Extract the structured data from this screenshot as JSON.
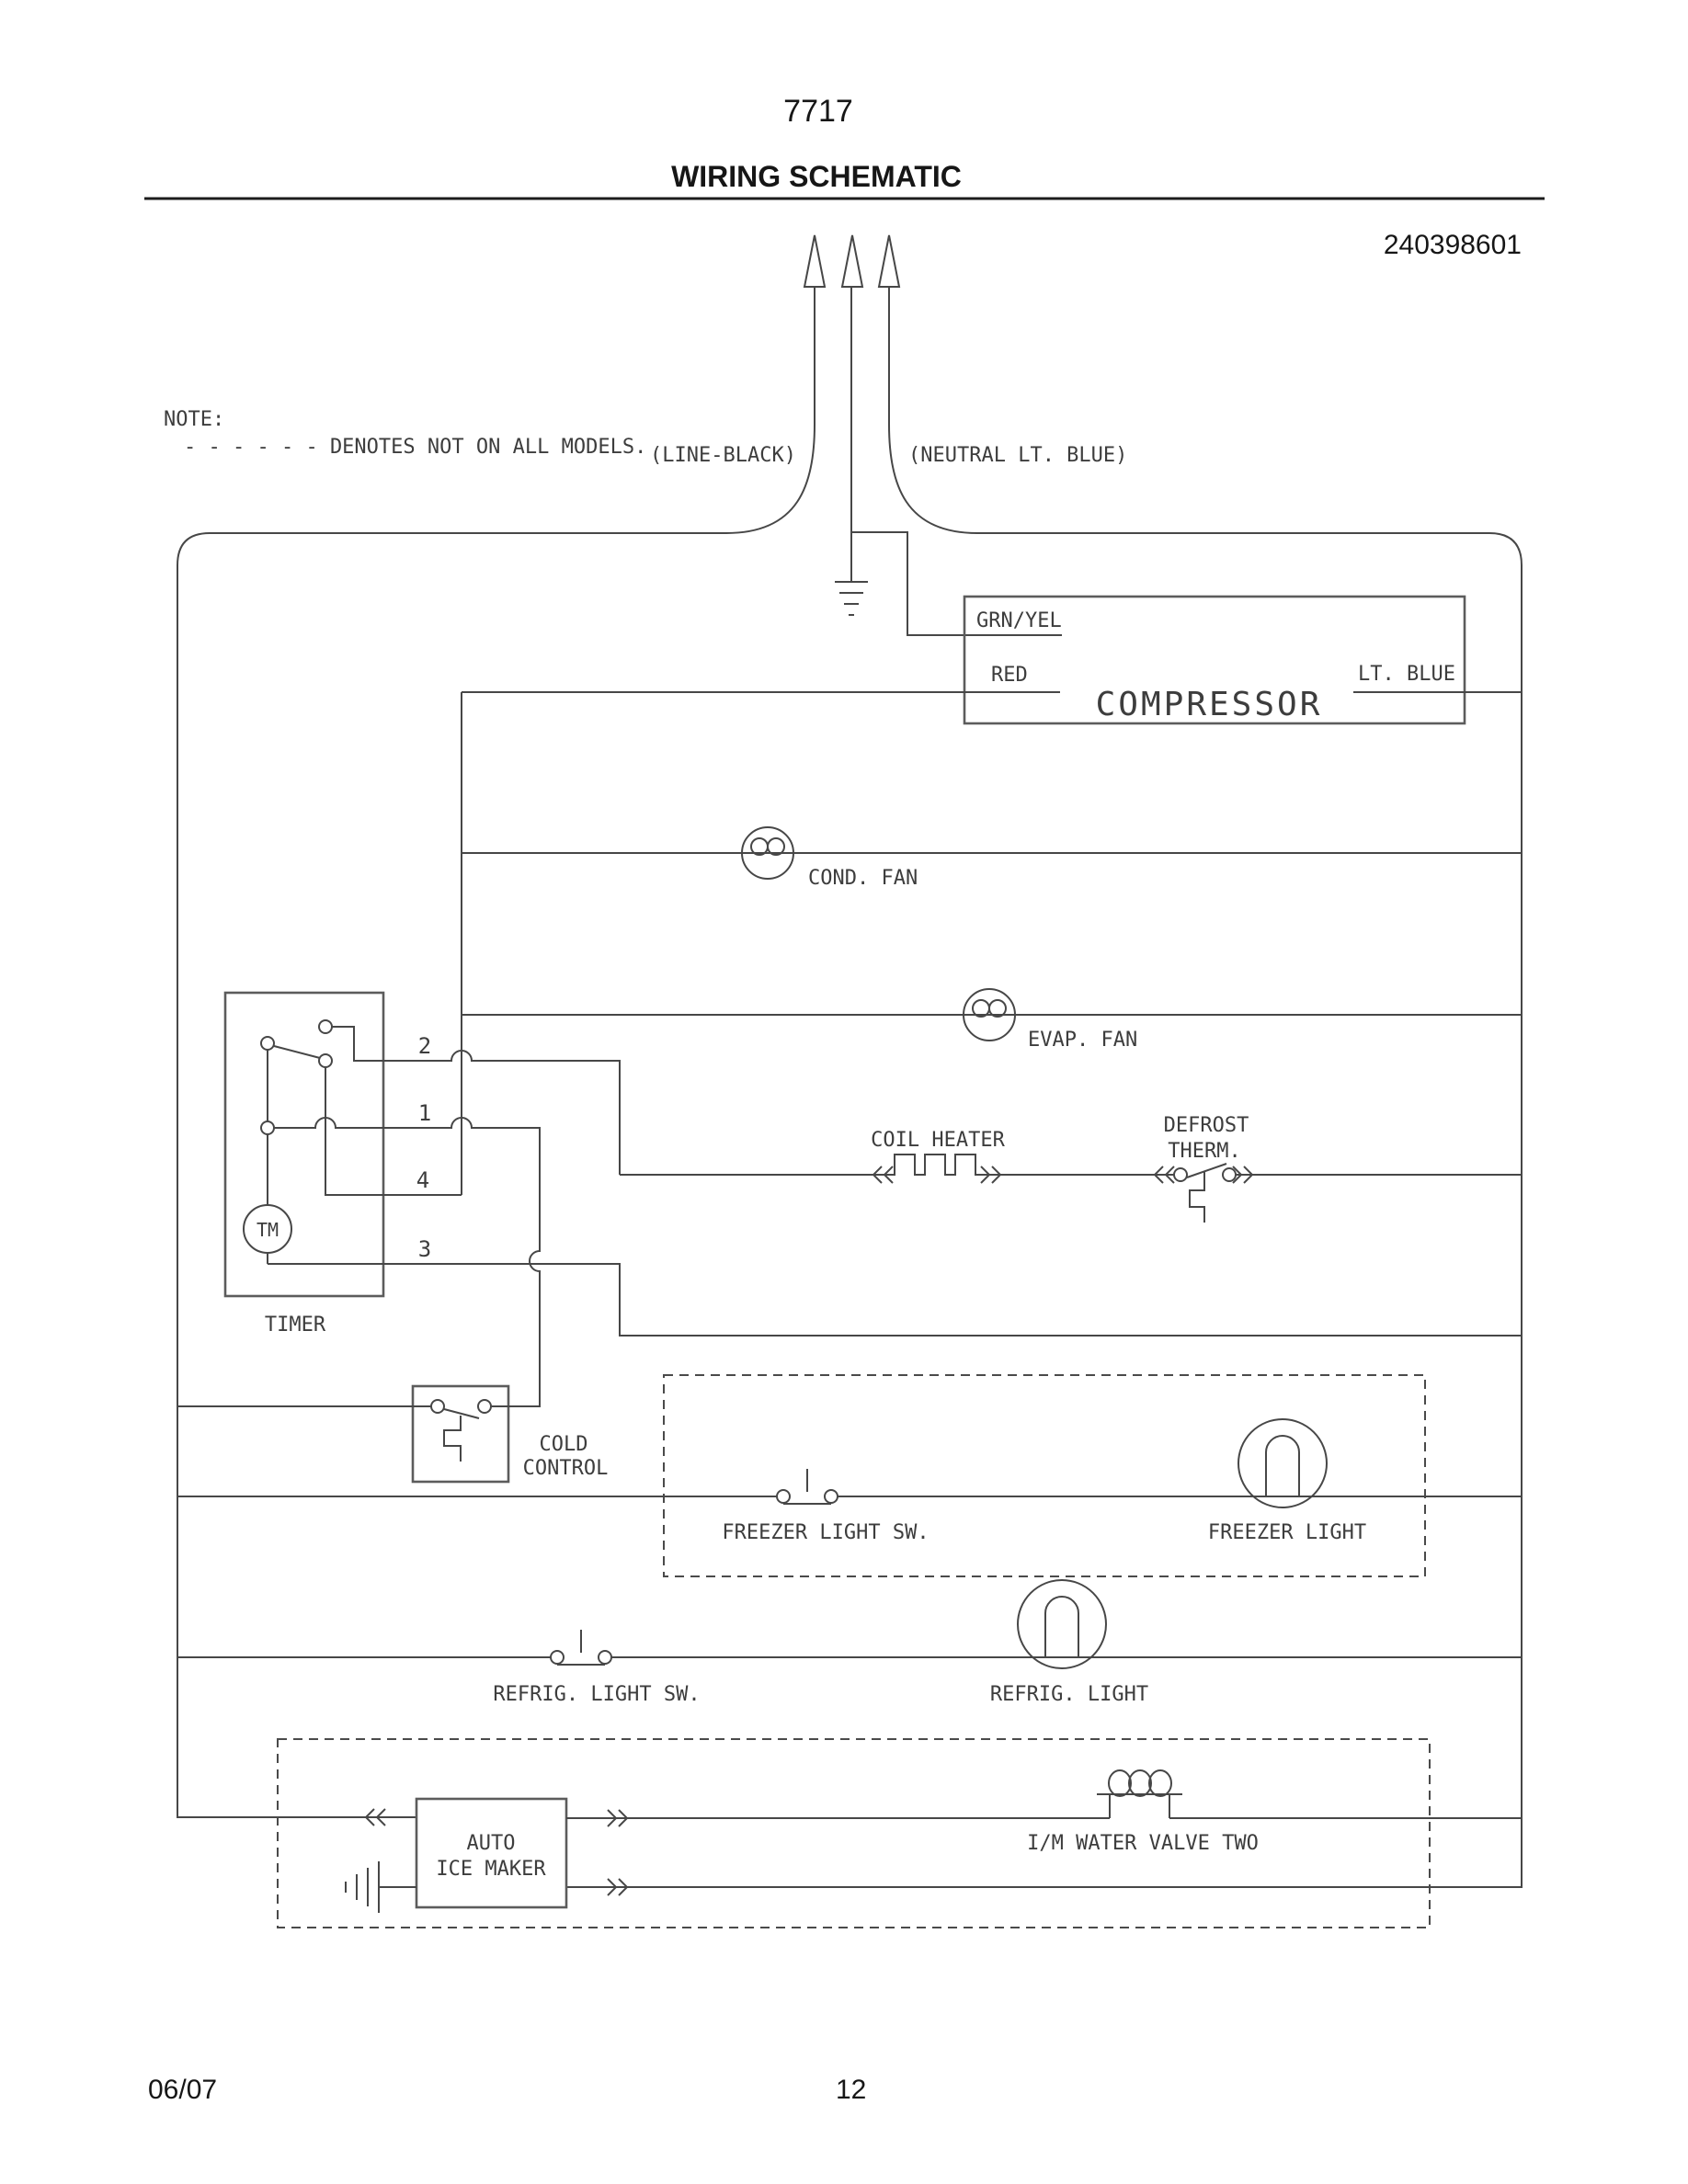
{
  "header": {
    "doc_number": "7717",
    "title": "WIRING SCHEMATIC",
    "part_number": "240398601"
  },
  "note": {
    "line1": "NOTE:",
    "line2": "- - - - - - DENOTES NOT ON ALL MODELS."
  },
  "supply": {
    "line_label": "(LINE-BLACK)",
    "neutral_label": "(NEUTRAL LT. BLUE)"
  },
  "components": {
    "compressor": {
      "label": "COMPRESSOR",
      "wire_ground": "GRN/YEL",
      "wire_left": "RED",
      "wire_right": "LT. BLUE"
    },
    "cond_fan": "COND. FAN",
    "evap_fan": "EVAP. FAN",
    "coil_heater": "COIL HEATER",
    "defrost_therm_line1": "DEFROST",
    "defrost_therm_line2": "THERM.",
    "timer": {
      "label": "TIMER",
      "motor": "TM",
      "terminals": [
        "2",
        "1",
        "4",
        "3"
      ]
    },
    "cold_control_line1": "COLD",
    "cold_control_line2": "CONTROL",
    "freezer_light_sw": "FREEZER LIGHT SW.",
    "freezer_light": "FREEZER LIGHT",
    "refrig_light_sw": "REFRIG. LIGHT SW.",
    "refrig_light": "REFRIG. LIGHT",
    "ice_maker_line1": "AUTO",
    "ice_maker_line2": "ICE MAKER",
    "water_valve": "I/M WATER VALVE TWO"
  },
  "footer": {
    "date": "06/07",
    "page_number": "12"
  }
}
